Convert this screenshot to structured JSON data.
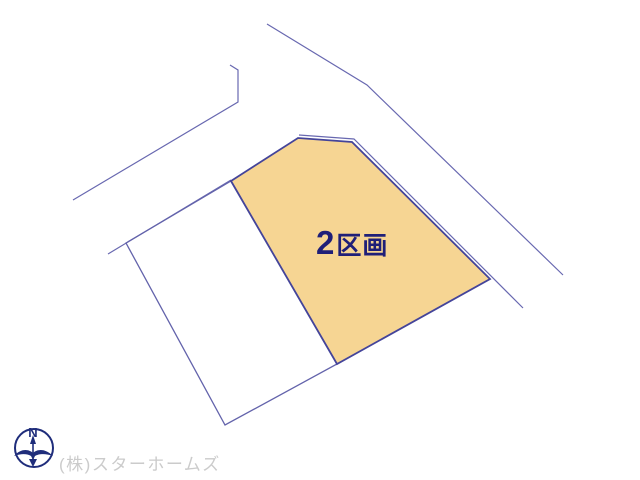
{
  "page": {
    "background": "#ffffff"
  },
  "colors": {
    "road_line": "#6868b0",
    "parcel_border": "#44449a",
    "vacant_parcel_border": "#6363ab",
    "highlight_fill": "#f6d593",
    "label_text": "#1f1f78",
    "credit_text": "#cbcbcb",
    "compass": "#1f2d7b"
  },
  "plan": {
    "road_lines": [
      {
        "name": "road-edge-top-left",
        "points": "230,65 238,70 238,102 73,200",
        "width": 1.2
      },
      {
        "name": "block-frontage-left",
        "points": "231,180 108,254",
        "width": 1.2
      },
      {
        "name": "road-edge-right",
        "points": "267,24 367,85 563,275",
        "width": 1.2
      },
      {
        "name": "road-boundary-northeast",
        "points": "299,135 354,139 523,308",
        "width": 1.2
      }
    ],
    "parcels": [
      {
        "name": "parcel-vacant-left",
        "points": "126,243 231,181 337,364 225,425",
        "fill": "none",
        "stroke": "#6363ab",
        "stroke_width": 1.3,
        "label": ""
      },
      {
        "name": "parcel-2-highlighted",
        "points": "231,181 298,138 352,142 490,279 337,364",
        "fill": "#f6d593",
        "stroke": "#44449a",
        "stroke_width": 1.8,
        "label": "2区画"
      }
    ],
    "label": {
      "text": "2区画",
      "number": "2",
      "suffix": "区画"
    }
  },
  "compass": {
    "letter": "N"
  },
  "credit": {
    "text": "(株)スターホームズ"
  }
}
